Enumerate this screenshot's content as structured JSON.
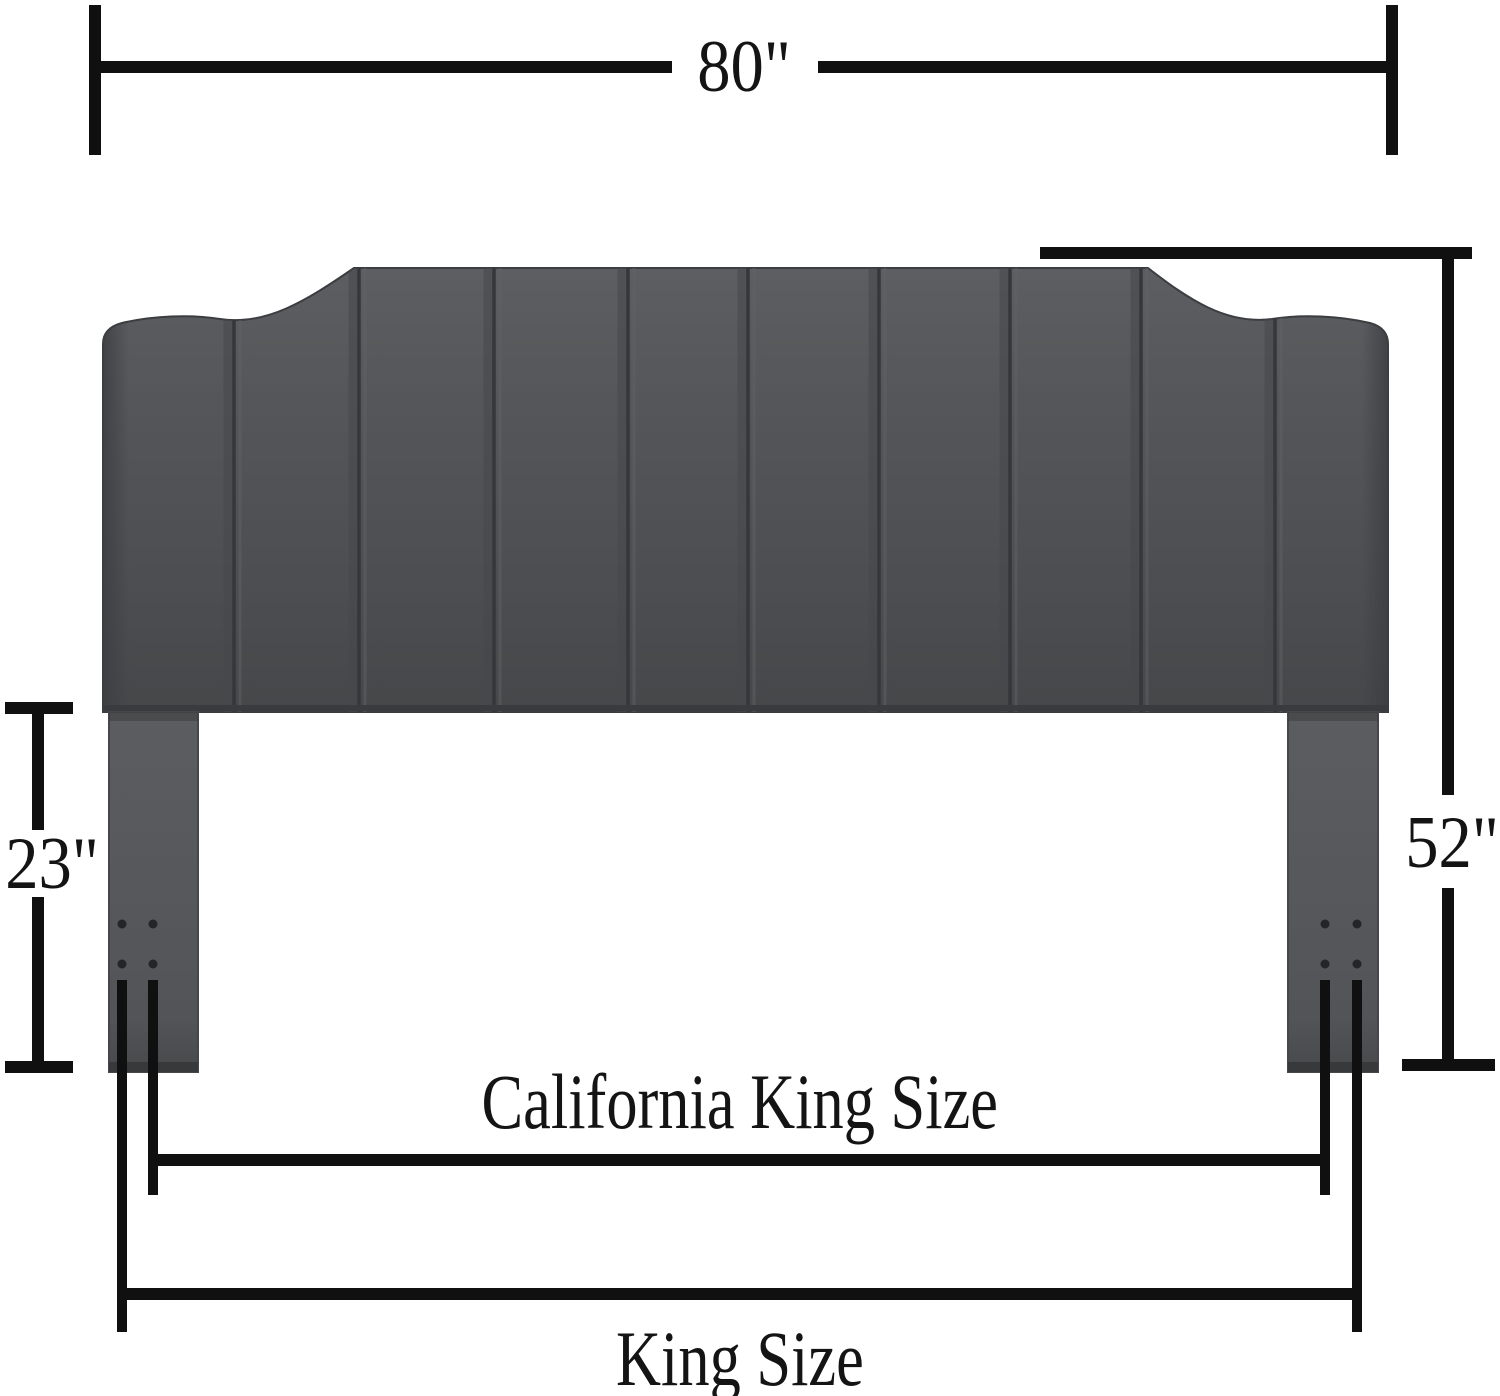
{
  "diagram": {
    "type": "product-dimension-diagram",
    "subject": "upholstered-channel-tufted-headboard",
    "labels": {
      "width": "80\"",
      "overall_height": "52\"",
      "leg_height": "23\"",
      "inner_span": "California King Size",
      "outer_span": "King Size"
    },
    "product": {
      "panel_count": 10,
      "legs": 2,
      "bolt_holes_per_leg": 4
    },
    "colors": {
      "background": "#ffffff",
      "dimension_line": "#101010",
      "text": "#141414",
      "upholstery_light": "#5c5e61",
      "upholstery_mid": "#4f5154",
      "upholstery_dark": "#454749",
      "seam": "#35373a",
      "leg": "#56585b",
      "bolt_hole": "#232527"
    }
  }
}
